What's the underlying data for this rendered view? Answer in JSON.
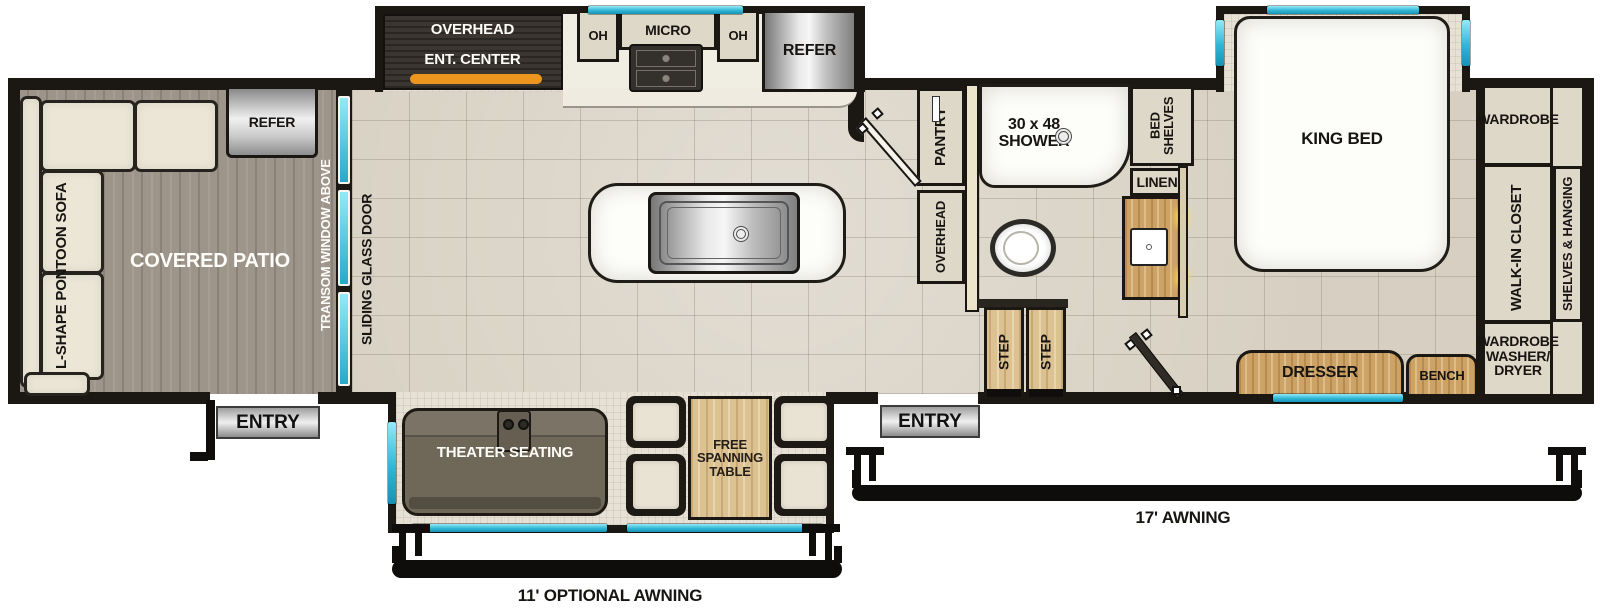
{
  "colors": {
    "window": "#2fb6d6",
    "accent_orange": "#ec9620",
    "wall": "#1b1713"
  },
  "floorplan": {
    "patio": {
      "refer": "REFER",
      "sofa": "L-SHAPE PONTOON SOFA",
      "area": "COVERED PATIO",
      "transom": "TRANSOM WINDOW ABOVE",
      "entry": "ENTRY"
    },
    "kitchen": {
      "overhead": "OVERHEAD",
      "ent_center": "ENT. CENTER",
      "oh_left": "OH",
      "micro": "MICRO",
      "oh_right": "OH",
      "refer": "REFER",
      "sliding_door": "SLIDING GLASS DOOR"
    },
    "bath": {
      "pantry": "PANTRY",
      "overhead": "OVERHEAD",
      "shower": "30 x 48\nSHOWER",
      "linen": "LINEN"
    },
    "bedroom": {
      "bed_shelves": "BED\nSHELVES",
      "king_bed": "KING BED",
      "dresser": "DRESSER",
      "bench": "BENCH",
      "step_left": "STEP",
      "step_right": "STEP",
      "entry": "ENTRY"
    },
    "closet": {
      "wardrobe": "WARDROBE",
      "walk_in": "WALK-IN CLOSET",
      "shelves_hanging": "SHELVES & HANGING",
      "washer_dryer": "WARDROBE\nWASHER/\nDRYER"
    },
    "living": {
      "theater": "THEATER SEATING",
      "table": "FREE\nSPANNING\nTABLE"
    },
    "exterior": {
      "awning_front": "17' AWNING",
      "awning_rear": "11' OPTIONAL AWNING"
    }
  }
}
